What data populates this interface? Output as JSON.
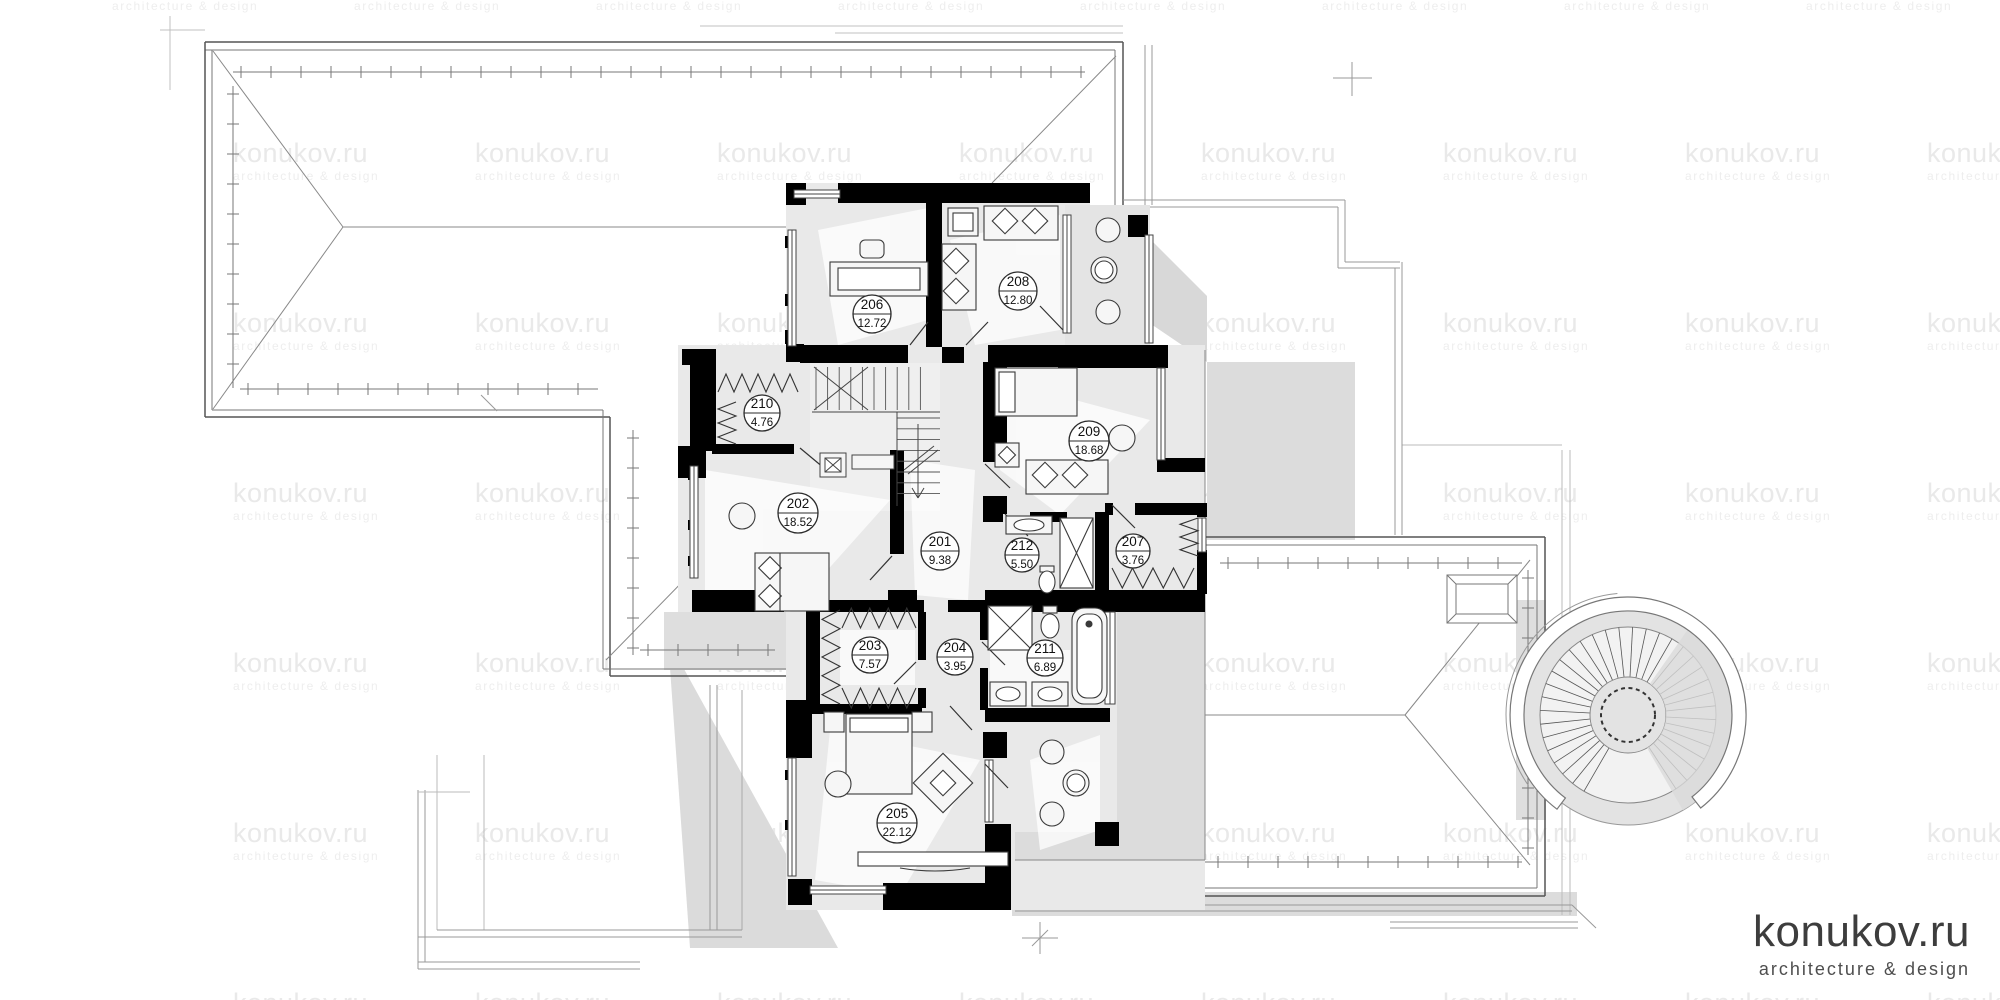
{
  "watermark": {
    "brand": "konukov.ru",
    "tagline": "architecture & design"
  },
  "logo": {
    "brand": "konukov.ru",
    "tagline": "architecture & design"
  },
  "plan": {
    "rooms": [
      {
        "number": "201",
        "area": "9.38"
      },
      {
        "number": "202",
        "area": "18.52"
      },
      {
        "number": "203",
        "area": "7.57"
      },
      {
        "number": "204",
        "area": "3.95"
      },
      {
        "number": "205",
        "area": "22.12"
      },
      {
        "number": "206",
        "area": "12.72"
      },
      {
        "number": "207",
        "area": "3.76"
      },
      {
        "number": "208",
        "area": "12.80"
      },
      {
        "number": "209",
        "area": "18.68"
      },
      {
        "number": "210",
        "area": "4.76"
      },
      {
        "number": "211",
        "area": "6.89"
      },
      {
        "number": "212",
        "area": "5.50"
      }
    ]
  },
  "colors": {
    "wall": "#000000",
    "room_fill": "#e9e9e9",
    "terrace_fill": "#dcdcdc",
    "shadow": "#d8d8d8",
    "watermark_text": "#e9e9e9",
    "logo_text": "#3d3d3d"
  }
}
